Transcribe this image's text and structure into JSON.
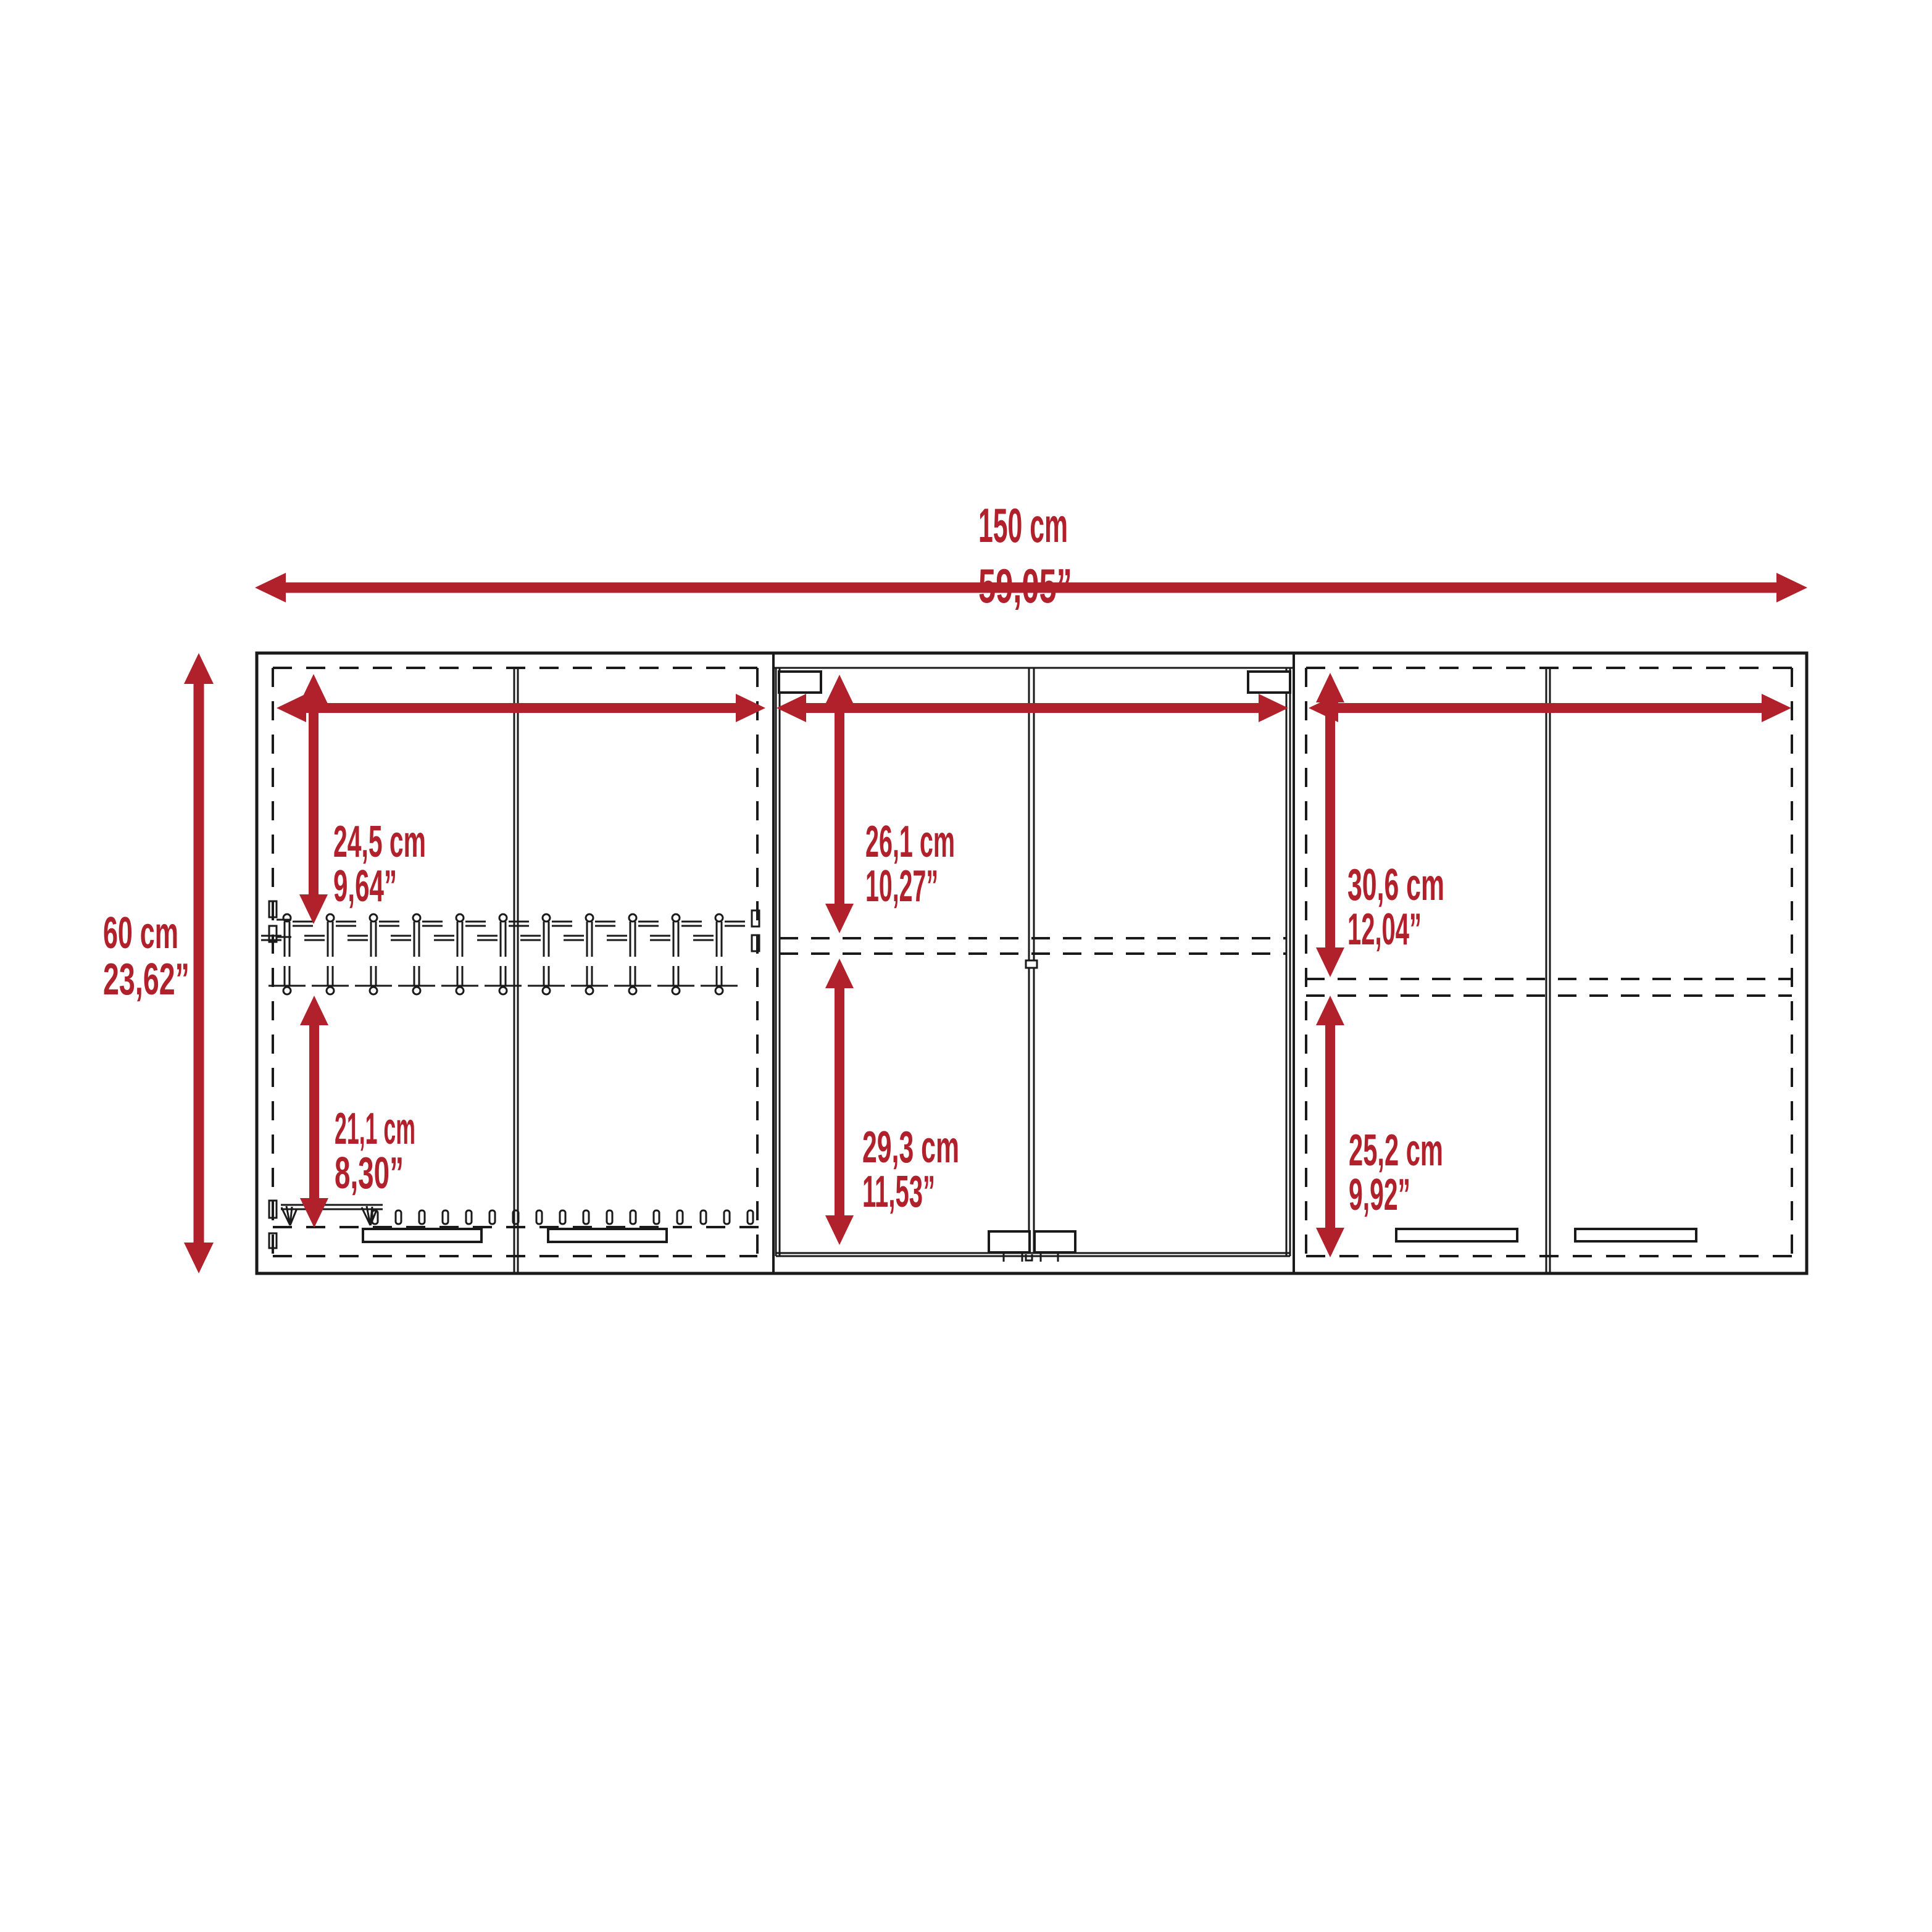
{
  "drawing": {
    "type": "wall-cabinet dimension diagram",
    "sections": [
      "left double-door unit with glassware rack",
      "middle glass-door unit",
      "right double-door unit"
    ],
    "colors": {
      "dimension_red": "#b0212c",
      "line_black": "#1a1a1a",
      "background": "#ffffff"
    }
  },
  "dims": {
    "overall_width": {
      "cm": "150 cm",
      "inches": "59,05”"
    },
    "overall_height": {
      "cm": "60 cm",
      "inches": "23,62”"
    },
    "left_upper": {
      "cm": "24,5 cm",
      "inches": "9,64”"
    },
    "left_lower": {
      "cm": "21,1 cm",
      "inches": "8,30”"
    },
    "middle_upper": {
      "cm": "26,1 cm",
      "inches": "10,27”"
    },
    "middle_lower": {
      "cm": "29,3 cm",
      "inches": "11,53”"
    },
    "right_upper": {
      "cm": "30,6 cm",
      "inches": "12,04”"
    },
    "right_lower": {
      "cm": "25,2 cm",
      "inches": "9,92”"
    }
  }
}
